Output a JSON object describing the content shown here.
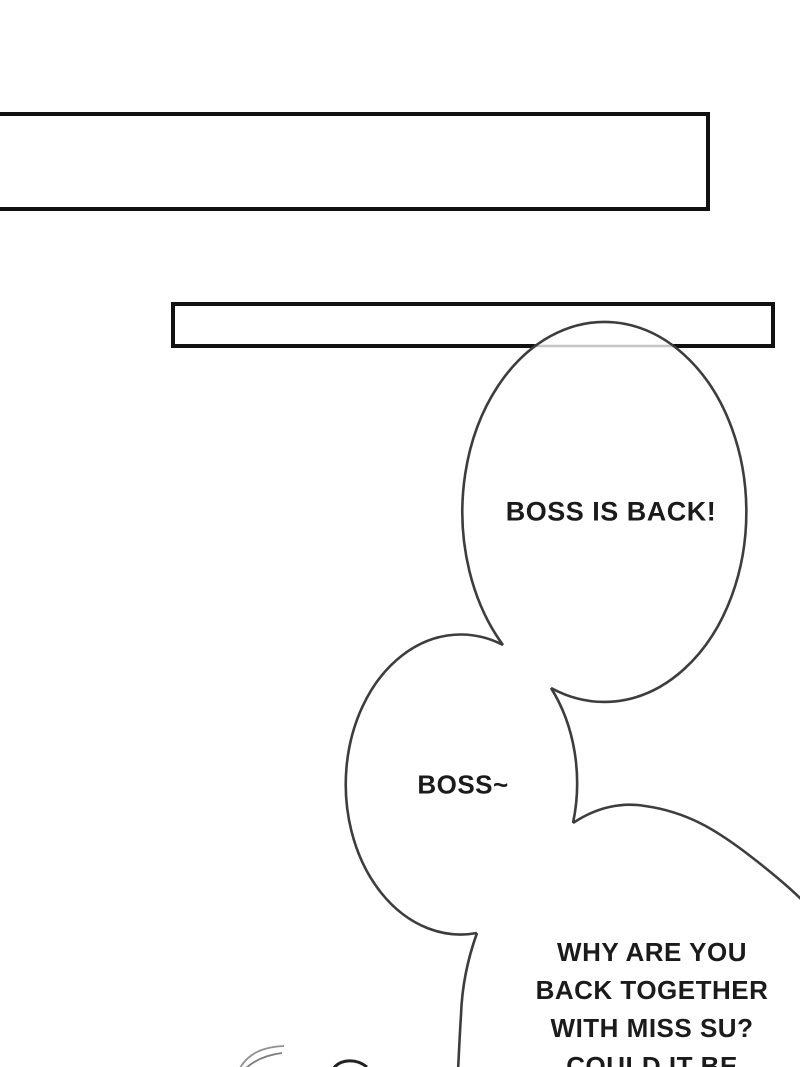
{
  "page": {
    "width": 800,
    "height": 1067,
    "background": "#ffffff",
    "kind": "comic-page"
  },
  "caption_boxes": [
    {
      "name": "top-caption-box",
      "text": ""
    },
    {
      "name": "second-caption-box",
      "text": ""
    }
  ],
  "speech_bubbles": [
    {
      "name": "bubble-boss-is-back",
      "text": "BOSS IS BACK!"
    },
    {
      "name": "bubble-boss",
      "text": "BOSS~"
    },
    {
      "name": "bubble-why-are-you",
      "lines": [
        "WHY ARE YOU",
        "BACK TOGETHER",
        "WITH MISS SU?",
        "COULD IT BE"
      ]
    }
  ],
  "colors": {
    "ink": "#111111",
    "bubble_stroke": "#3d3d3d",
    "text_color": "#1b1b1b",
    "faded_line": "#c6c6c6",
    "hair_stroke": "#909090",
    "head_stroke": "#222222",
    "background": "#ffffff"
  }
}
